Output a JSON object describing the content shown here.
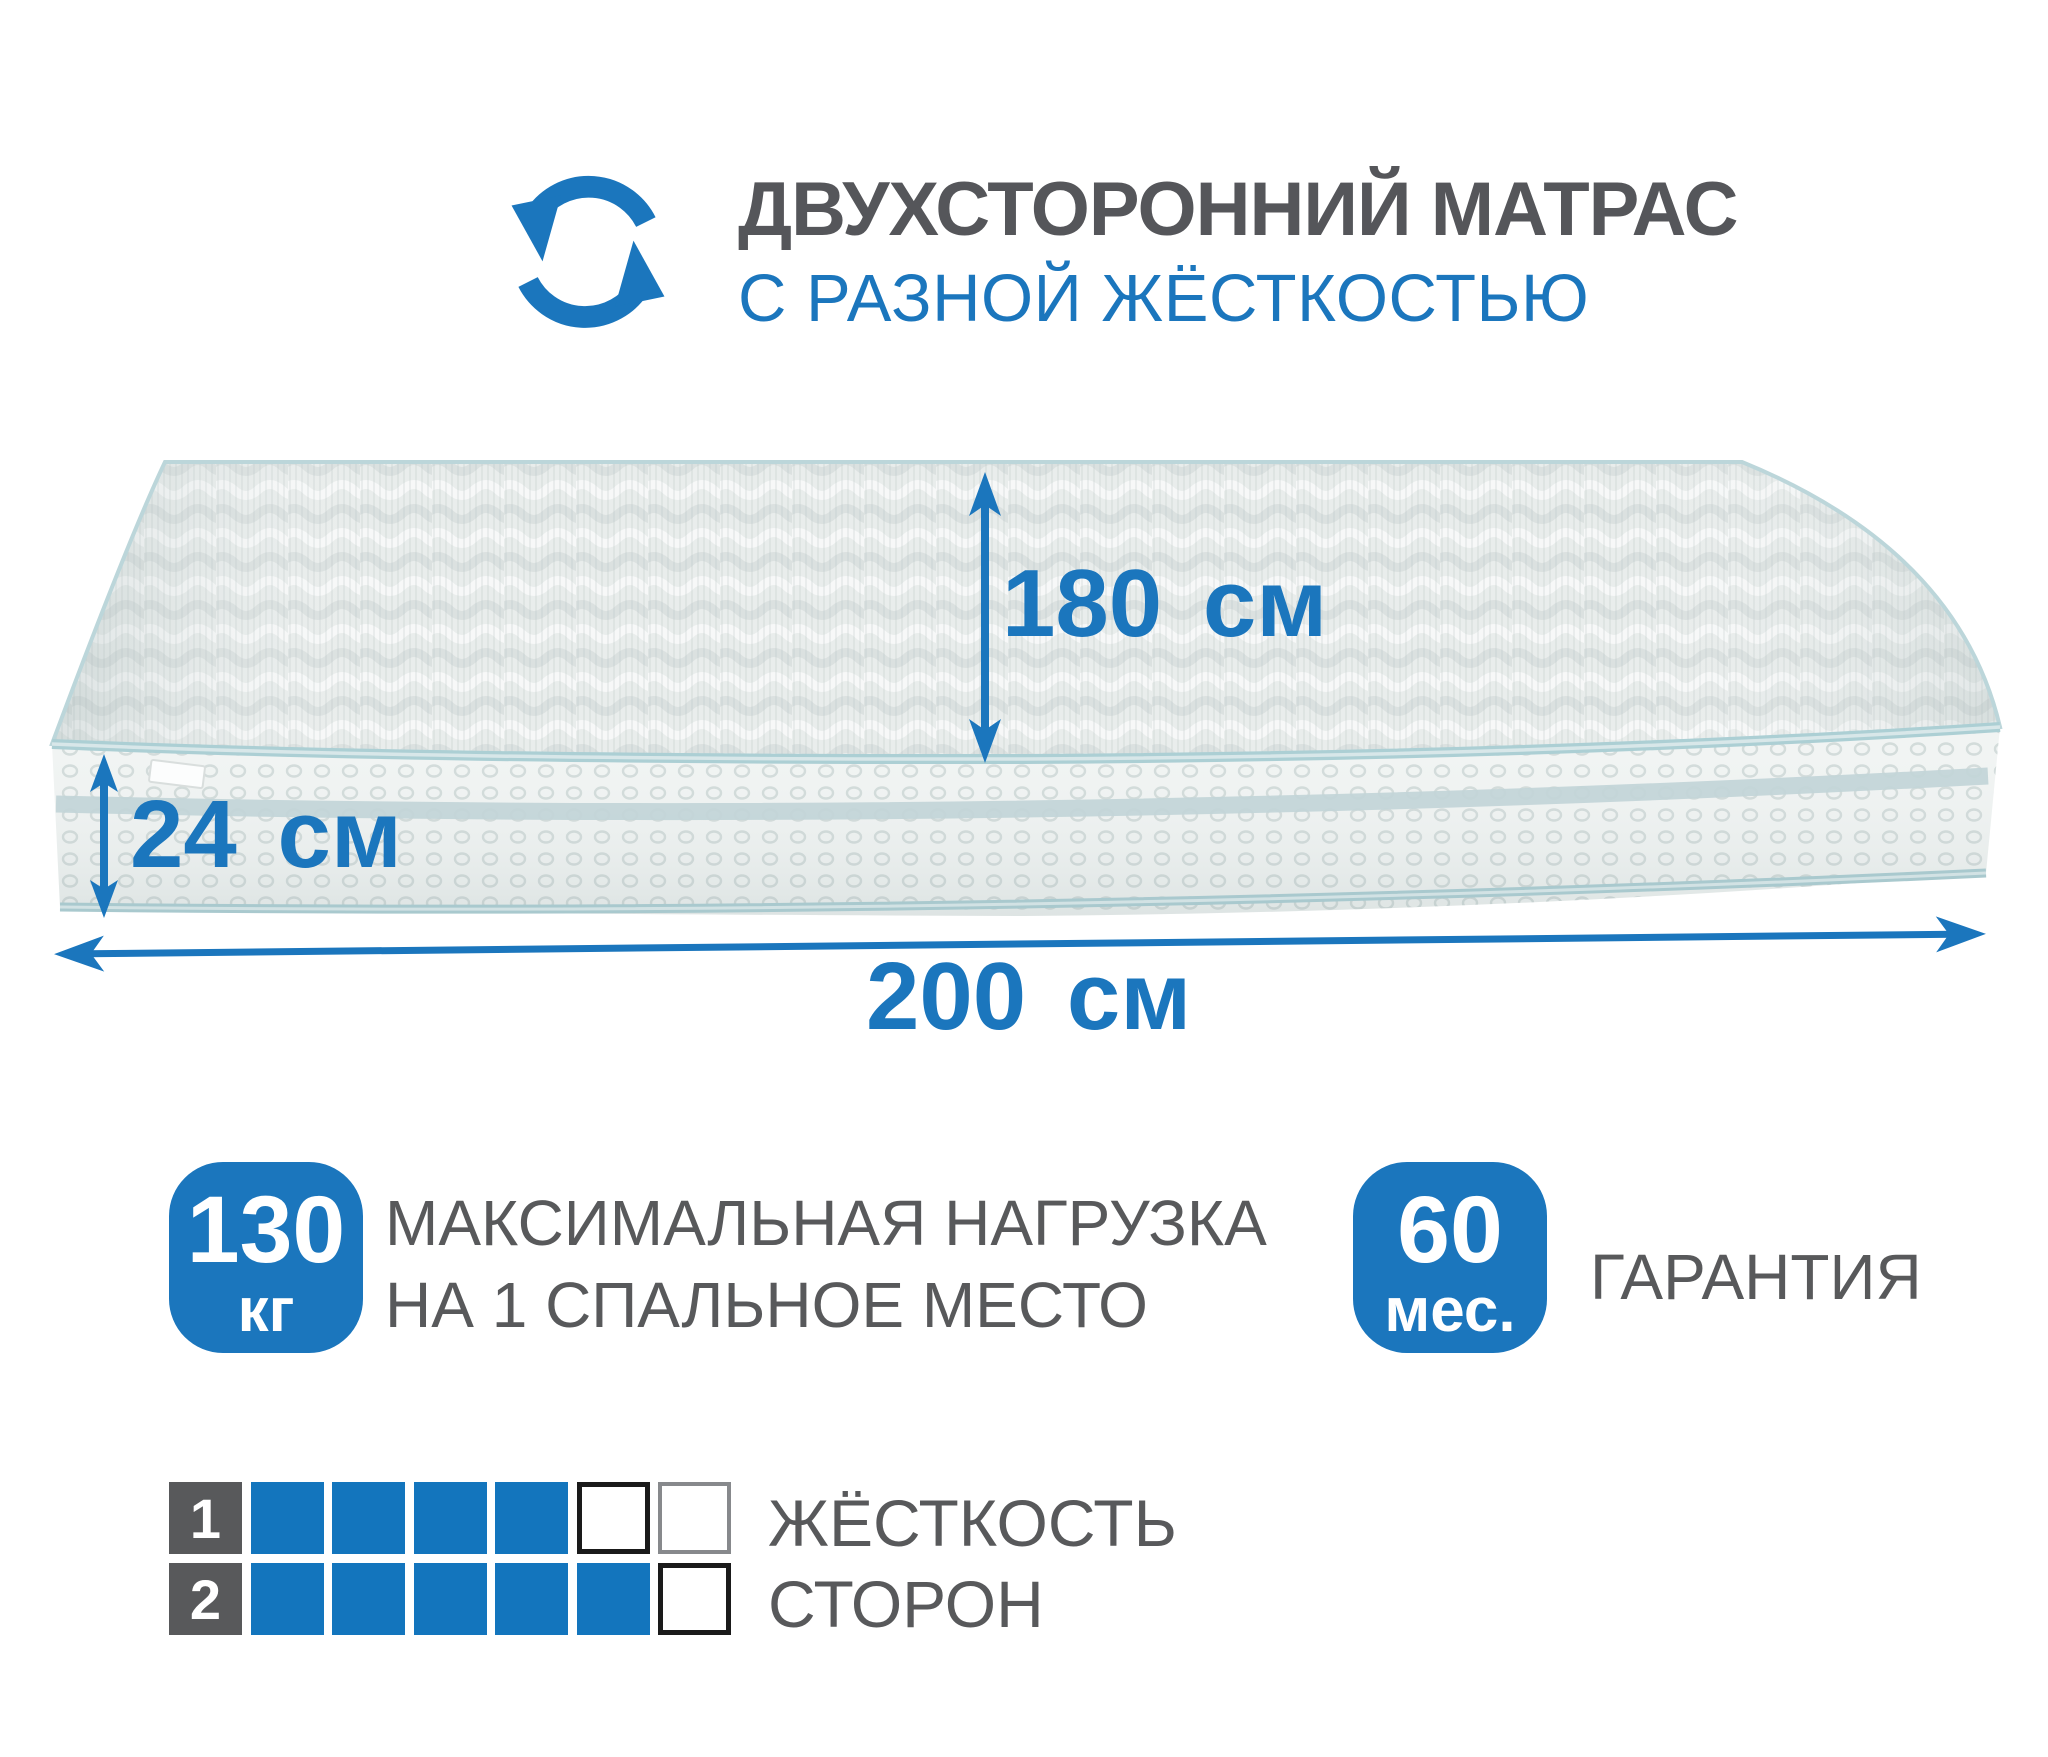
{
  "header": {
    "title": "ДВУХСТОРОННИЙ МАТРАС",
    "subtitle": "С РАЗНОЙ ЖЁСТКОСТЬЮ",
    "icon": "rotate-arrows-icon"
  },
  "dimensions": {
    "depth_label": "180 см",
    "thickness_label": "24 см",
    "width_label": "200 см"
  },
  "badges": {
    "load": {
      "value": "130",
      "unit": "кг",
      "description": "МАКСИМАЛЬНАЯ НАГРУЗКА\nНА 1 СПАЛЬНОЕ МЕСТО"
    },
    "warranty": {
      "value": "60",
      "unit": "мес.",
      "label": "ГАРАНТИЯ"
    }
  },
  "hardness": {
    "label_line1": "ЖЁСТКОСТЬ",
    "label_line2": "СТОРОН",
    "rows": [
      {
        "index": "1",
        "filled": 4,
        "total": 6,
        "empty_border_colors": [
          "#1a1a1a",
          "#87898c"
        ]
      },
      {
        "index": "2",
        "filled": 5,
        "total": 6,
        "empty_border_colors": [
          "#1a1a1a"
        ]
      }
    ]
  },
  "colors": {
    "accent": "#1b76bd",
    "square_blue": "#1375bd",
    "text_gray": "#58595b",
    "text_dark": "#55565a",
    "piping": "#accfd4"
  }
}
